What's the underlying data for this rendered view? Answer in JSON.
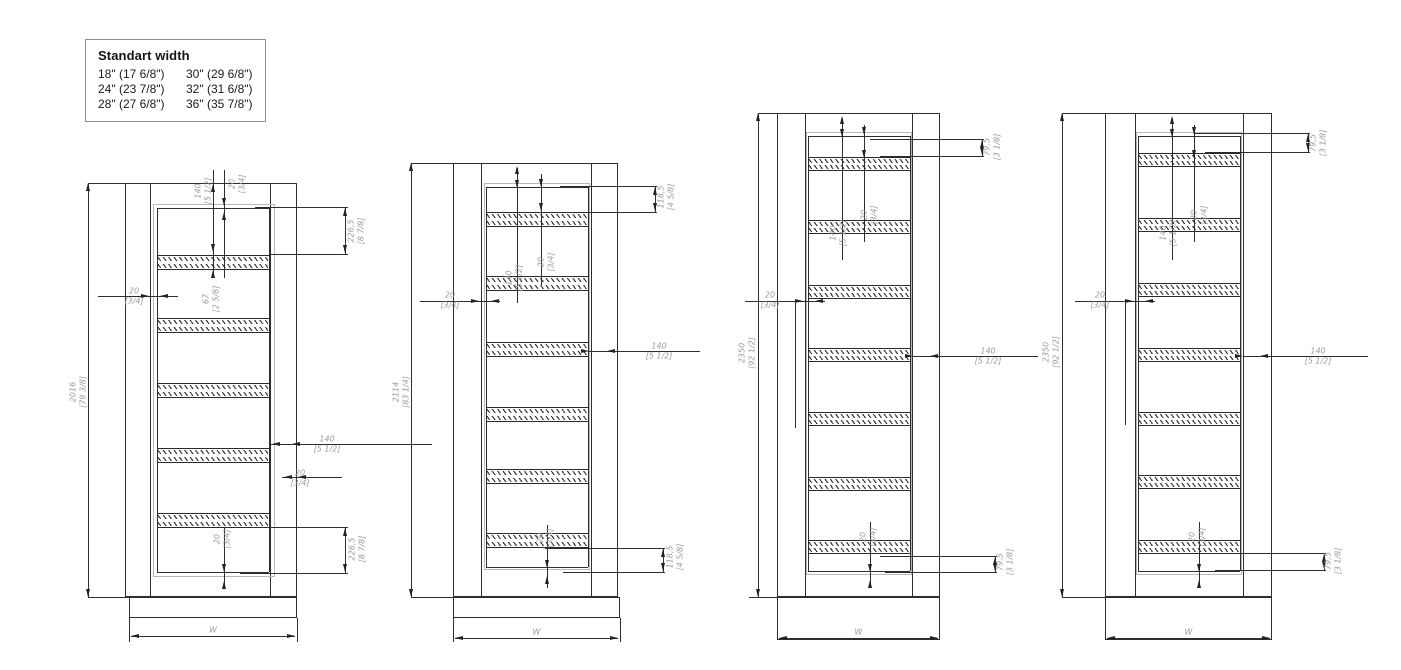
{
  "legend": {
    "title": "Standart width",
    "rows": [
      [
        "18\" (17 6/8\")",
        "30\" (29 6/8\")"
      ],
      [
        "24\" (23 7/8\")",
        "32\" (31 6/8\")"
      ],
      [
        "28\" (27 6/8\")",
        "36\" (35 7/8\")"
      ]
    ]
  },
  "doors": [
    {
      "louver_count": 5,
      "labels": {
        "height": "2016 [79 3/8]",
        "top1": "140 [5 1/2]",
        "top2": "20 [3/4]",
        "right_top": "226,5 [8 7/8]",
        "left": "20 [3/4]",
        "center": "67 [2 5/8]",
        "right_mid1": "140 [5 1/2]",
        "right_mid2": "20 [3/4]",
        "bottom_center": "20 [3/4]",
        "right_bottom": "226,5 [8 7/8]",
        "w": "W"
      }
    },
    {
      "louver_count": 6,
      "labels": {
        "height": "2114 [83 1/4]",
        "center1": "140 [5 1/2]",
        "center2": "20 [3/4]",
        "right_top": "118,5 [4 5/8]",
        "left": "20 [3/4]",
        "right_mid1": "140 [5 1/2]",
        "bottom_center": "20 [3/4]",
        "right_bottom": "118,5 [4 5/8]",
        "w": "W"
      }
    },
    {
      "louver_count": 7,
      "labels": {
        "height": "2350 [92 1/2]",
        "center1": "140 [5 1/2]",
        "center2": "20 [3/4]",
        "right_top": "79,5 [3 1/8]",
        "left": "20 [3/4]",
        "right_mid1": "140 [5 1/2]",
        "bottom_center": "20 [3/4]",
        "right_bottom": "79,5 [3 1/8]",
        "w": "W"
      }
    },
    {
      "louver_count": 7,
      "labels": {
        "height": "2350 [92 1/2]",
        "center1": "140 [5 1/2]",
        "center2": "20 [3/4]",
        "right_top": "79,5 [3 1/8]",
        "left": "20 [3/4]",
        "right_mid1": "140 [5 1/2]",
        "bottom_center": "20 [3/4]",
        "right_bottom": "79,5 [3 1/8]",
        "w": "W"
      }
    }
  ]
}
